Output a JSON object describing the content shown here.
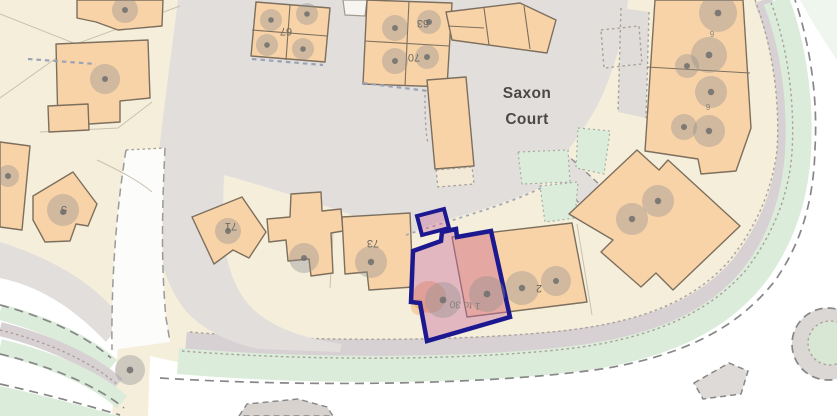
{
  "map": {
    "place_label": {
      "line1": "Saxon",
      "line2": "Court"
    },
    "house_numbers": {
      "n67": "67",
      "n63": "63",
      "n70": "70",
      "n71": "71",
      "n73": "73",
      "n5": "5"
    },
    "selected_property": {
      "range_label": "1 to 30",
      "adjacent_label": "2",
      "highlight_border_color": "#1c188f",
      "highlight_fill_color": "#c76b9a"
    },
    "flats_small_labels": {
      "glyph_a": "6",
      "glyph_b": "6"
    },
    "palette": {
      "parcel_beige": "#f5eedb",
      "building_orange": "#f8d3a8",
      "building_outline": "#7d6f5d",
      "road_gray": "#e2dedc",
      "green_space": "#dcecdb",
      "band_gray": "#d8d1d3",
      "tree_gray": "#8f8f8f",
      "label_gray": "#4b4945"
    }
  }
}
